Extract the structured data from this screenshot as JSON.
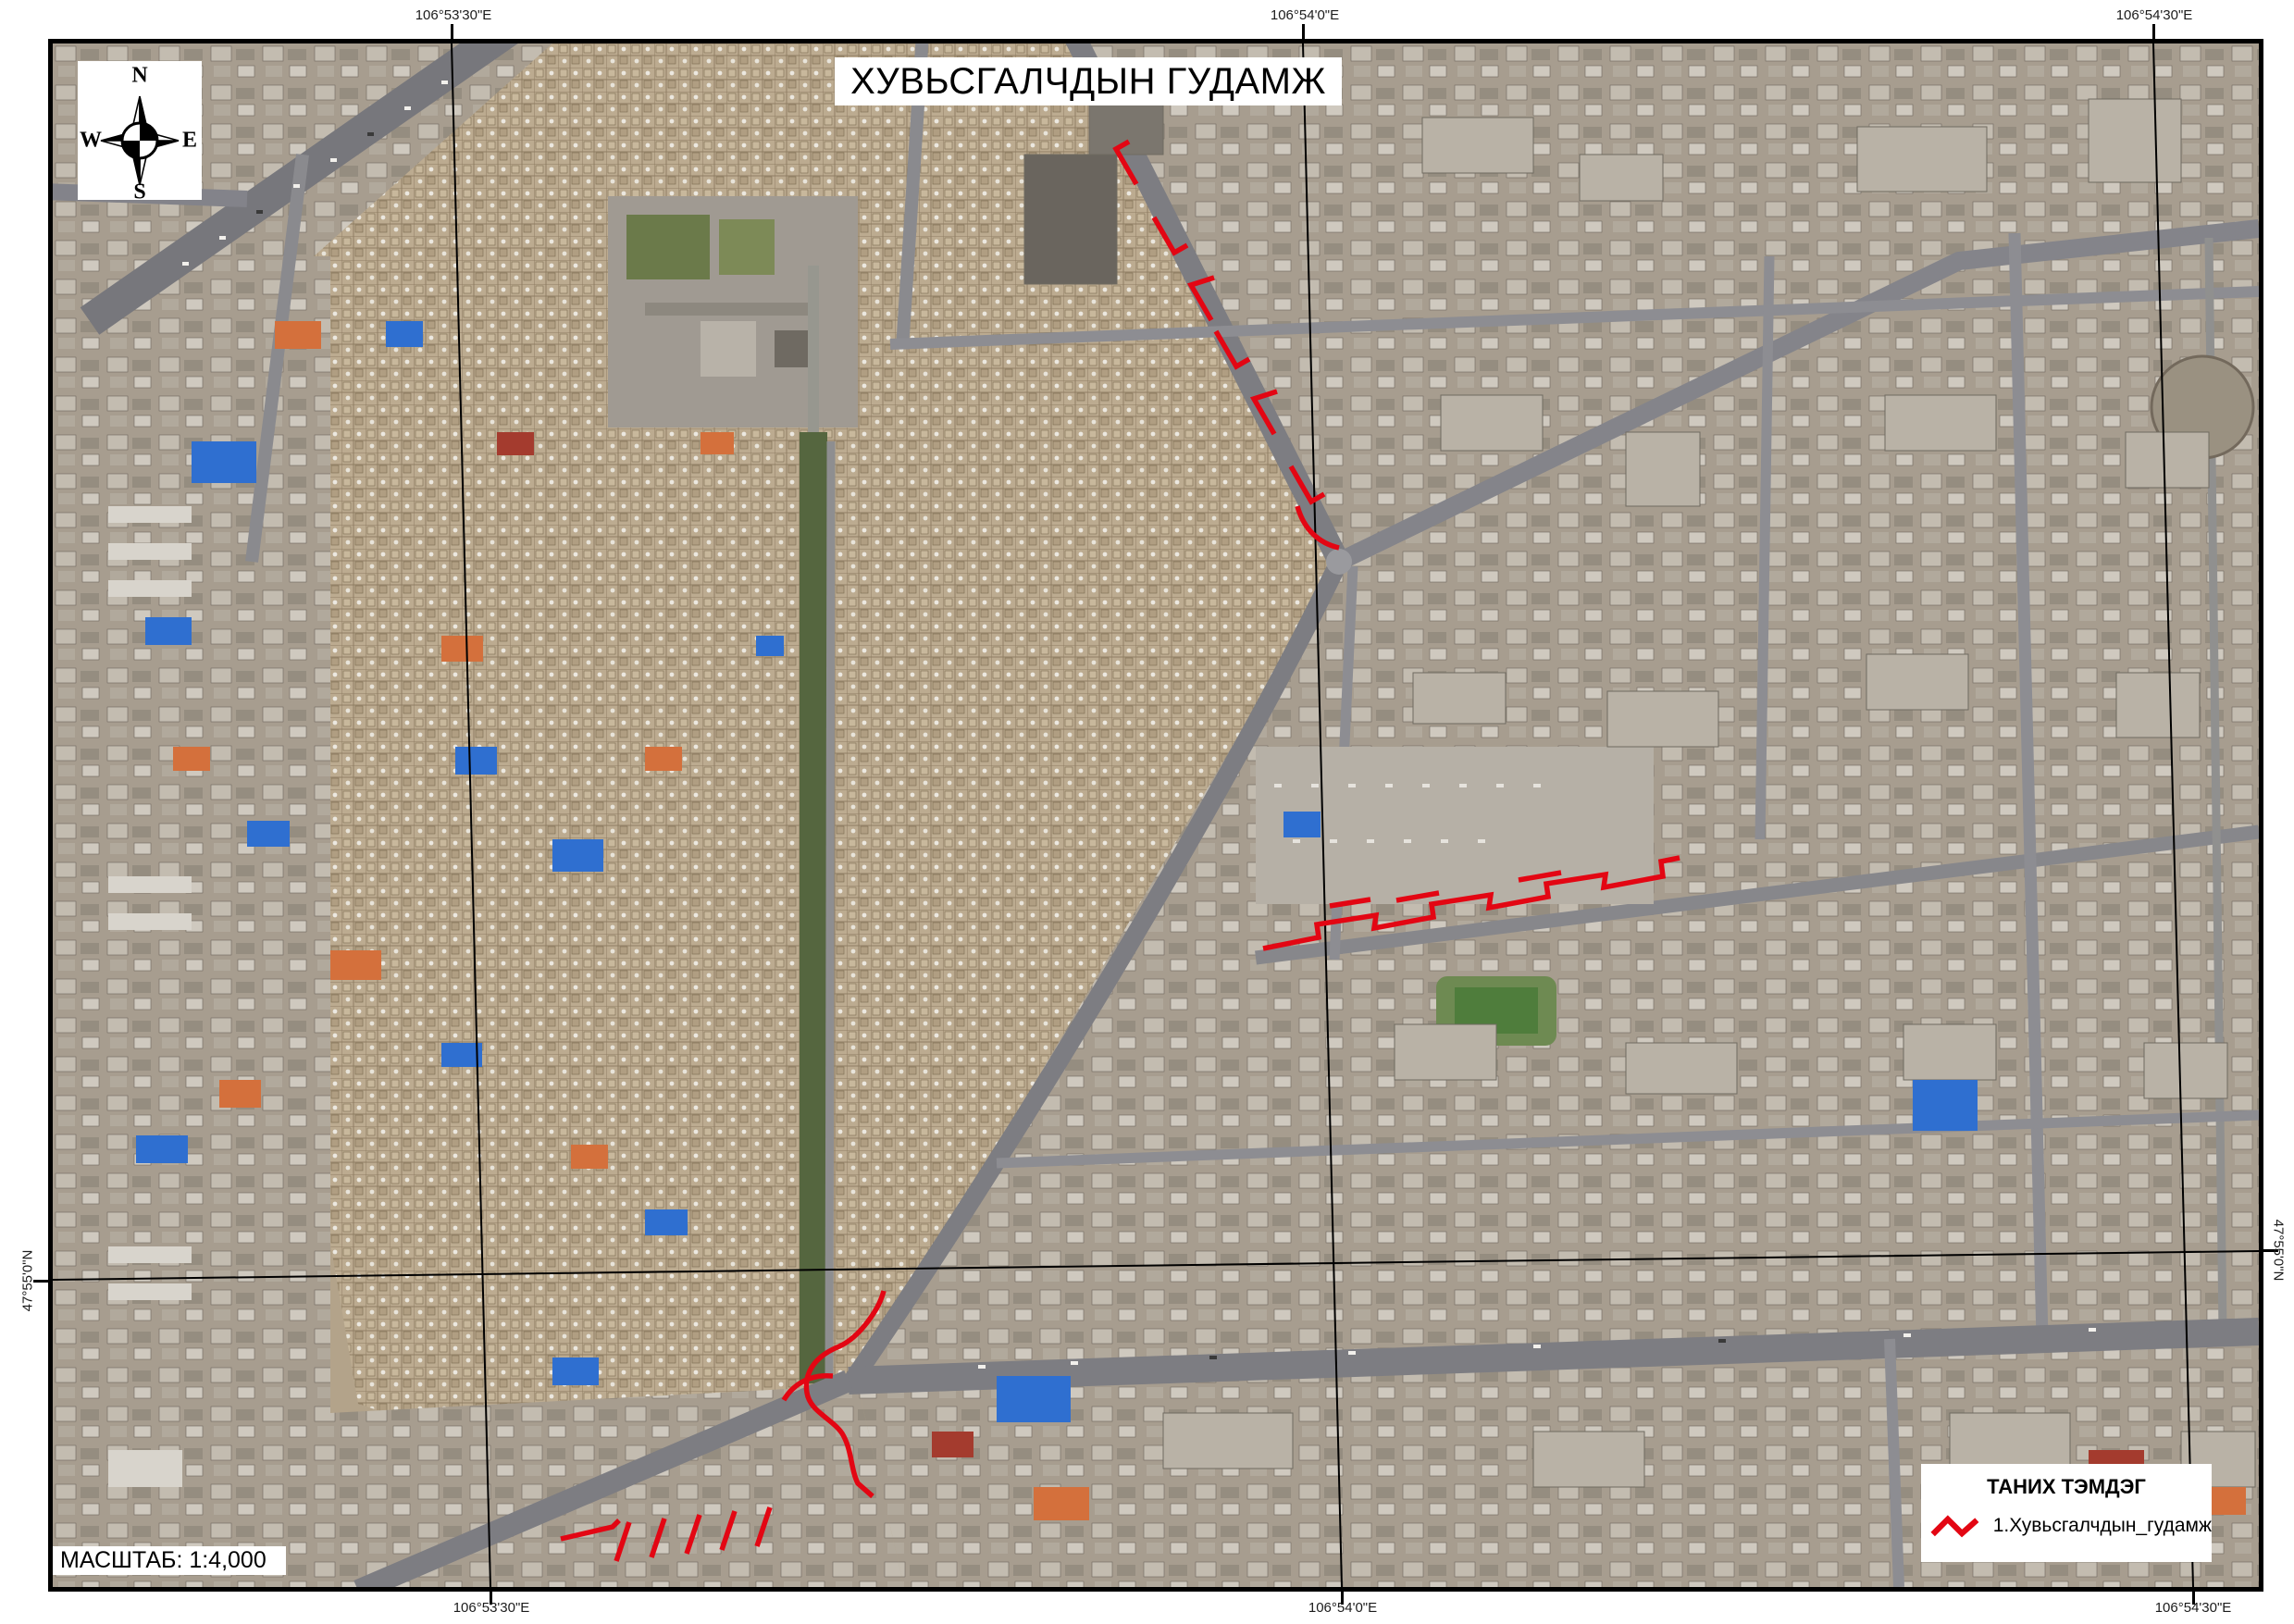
{
  "map": {
    "title": "ХУВЬСГАЛЧДЫН ГУДАМЖ",
    "scale_label": "МАСШТАБ: 1:4,000",
    "route_color": "#e30613",
    "compass": {
      "north": "N",
      "east": "E",
      "south": "S",
      "west": "W"
    },
    "legend": {
      "title": "ТАНИХ ТЭМДЭГ",
      "items": [
        {
          "symbol": "red-zigzag-line",
          "label": "1.Хувьсгалчдын_гудамж",
          "color": "#e30613"
        }
      ]
    },
    "graticule": {
      "top": [
        "106°53'30\"E",
        "106°54'0\"E",
        "106°54'30\"E"
      ],
      "bottom": [
        "106°53'30\"E",
        "106°54'0\"E",
        "106°54'30\"E"
      ],
      "left": [
        "47°55'0\"N"
      ],
      "right": [
        "47°55'0\"N"
      ]
    }
  }
}
